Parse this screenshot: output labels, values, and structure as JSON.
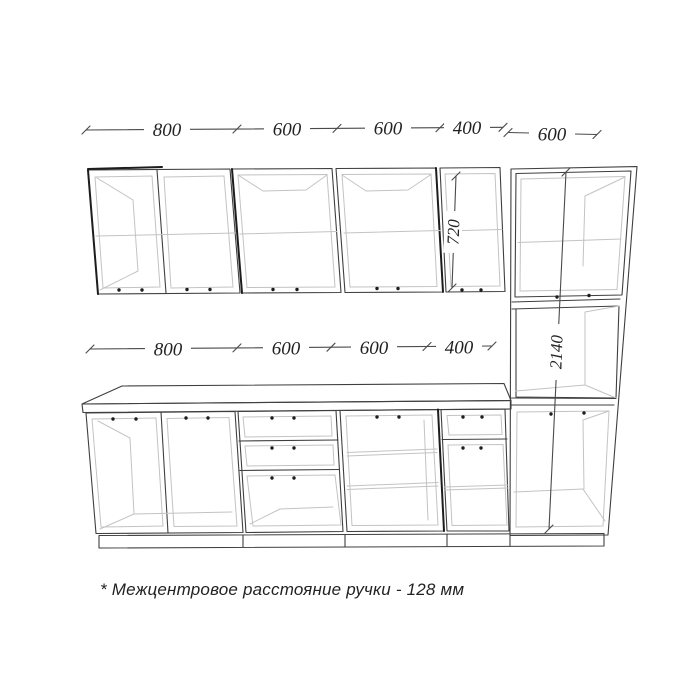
{
  "drawing": {
    "note": "* Межцентровое расстояние ручки - 128 мм",
    "dims": {
      "top": [
        "800",
        "600",
        "600",
        "400"
      ],
      "top_right": "600",
      "mid": [
        "800",
        "600",
        "600",
        "400"
      ],
      "wall_cabinet_height": "720",
      "tall_cabinet_height": "2140"
    }
  },
  "colors": {
    "bg": "#ffffff",
    "line": "#3f3f3f",
    "light": "#c3c3c3",
    "dark": "#1d1d1d",
    "dim": "#4a4a4a",
    "text": "#222222"
  }
}
